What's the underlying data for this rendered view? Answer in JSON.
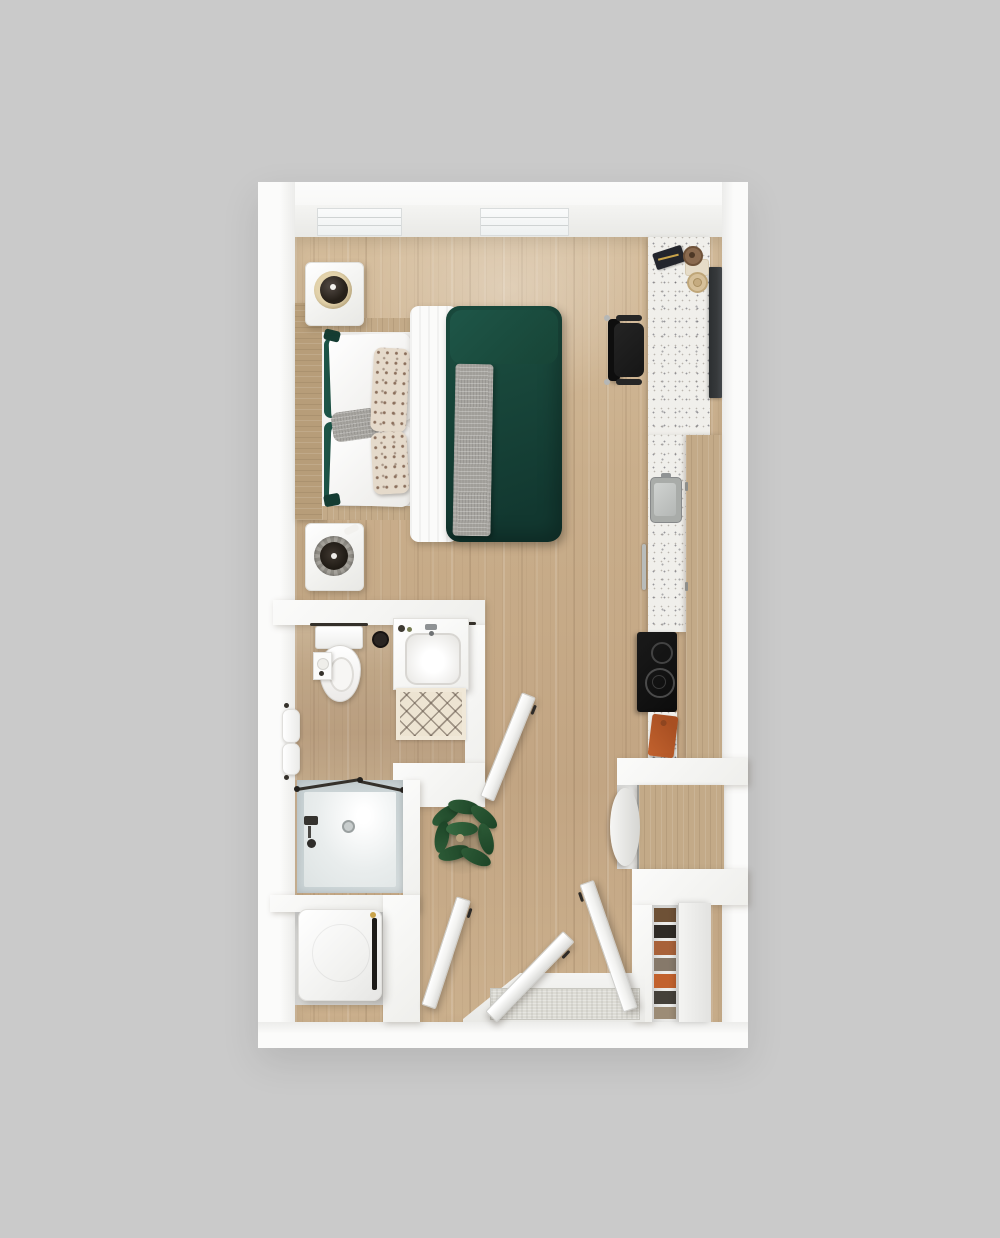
{
  "scene": {
    "type": "3d-rendered-floor-plan",
    "subject": "studio apartment, top-down view",
    "structure": {
      "windows": 2,
      "open_doors": 4
    }
  },
  "palette": {
    "background": "#cacaca",
    "wall": "#f7f7f5",
    "wall_shade": "#e9e9e6",
    "floor": "#c9ae8b",
    "floor_light": "#dcc6a5",
    "floor_dark": "#b69877",
    "wood": "#b79d79",
    "cabinet": "#c3aa88",
    "terrazzo": "#f0efeb",
    "duvet_green": "#1a4b3e",
    "duvet_dark": "#123830",
    "pillow_green": "#1c5447",
    "throw_gray": "#a7a5a0",
    "pattern_dot": "#8b6f5c",
    "glass": "#ccd5d7",
    "appliance_dark": "#1d1b18",
    "tv": "#36393b",
    "chair": "#161616",
    "rug": "#ede4d2",
    "rug_line": "#5f5146",
    "mat": "#dcdbd4",
    "orange": "#c2622e",
    "plant_green": "#2c5a36",
    "plant_dark": "#1d4527",
    "brass": "#c9a34a",
    "metal": "#b9bcba"
  },
  "labels": {
    "plan": "studio-floor-plan",
    "window": "window",
    "bed": "bed",
    "duvet": "green-duvet",
    "sheet": "white-folded-sheet",
    "throw": "gray-knit-throw",
    "headboard": "wood-headboard",
    "nightstand_top": "nightstand-with-lamp",
    "nightstand_bottom": "nightstand-with-lamp",
    "desk": "terrazzo-desk",
    "chair": "desk-chair",
    "tv": "wall-mounted-tv",
    "counter": "kitchen-counter",
    "kitchen_sink": "kitchen-sink",
    "dishwasher": "dishwasher-handle",
    "cooktop": "two-burner-cooktop",
    "cabinets": "tall-wood-cabinets",
    "cutting_board": "orange-cutting-board",
    "fridge": "panel-front-refrigerator",
    "toilet": "toilet",
    "vanity": "bathroom-vanity-sink",
    "bath_rug": "diamond-bath-rug",
    "towels": "hand-towels",
    "shower": "glass-walk-in-shower",
    "washer": "washer-dryer",
    "closet": "closet-shelves",
    "closet_panel": "closet-sliding-panel",
    "doormat": "entry-doormat",
    "landing": "entry-landing",
    "plant": "potted-plant",
    "door_bathroom": "bathroom-door",
    "door_laundry": "laundry-door",
    "door_entry": "entry-door",
    "door_closet": "closet-door"
  }
}
